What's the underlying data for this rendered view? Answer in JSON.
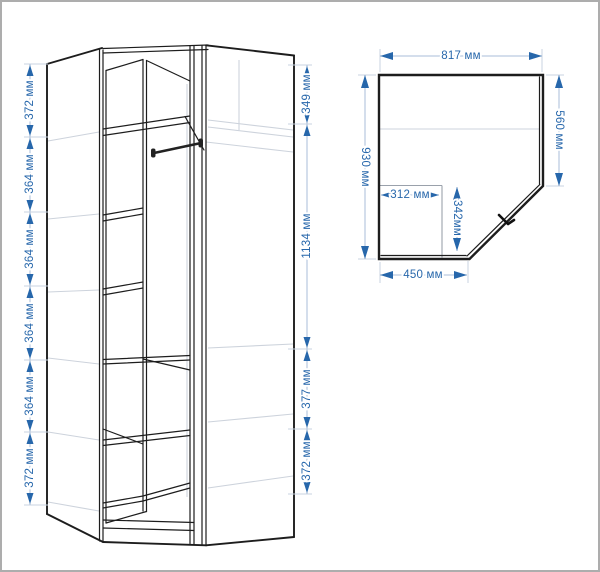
{
  "title": "Corner wardrobe technical drawing",
  "colors": {
    "accent": "#2767ab",
    "dim_line": "#a9bdd8",
    "extension_line": "#c9d3e2",
    "drawing_line": "#1d1d1d",
    "ghost_line": "#cdd3dc",
    "inner_line": "#9aa1ab",
    "frame_border": "#adadad"
  },
  "front_view": {
    "left_dims": [
      "372 мм",
      "364 мм",
      "364 мм",
      "364 мм",
      "364 мм",
      "372 мм"
    ],
    "right_dims": [
      "349 мм",
      "1134 мм",
      "377 мм",
      "372 мм"
    ]
  },
  "top_view": {
    "top_dim": "817 мм",
    "left_dim": "930 мм",
    "right_dim": "560 мм",
    "inner_width_dim": "312 мм",
    "inner_depth_dim": "342мм",
    "bottom_dim": "450 мм"
  }
}
